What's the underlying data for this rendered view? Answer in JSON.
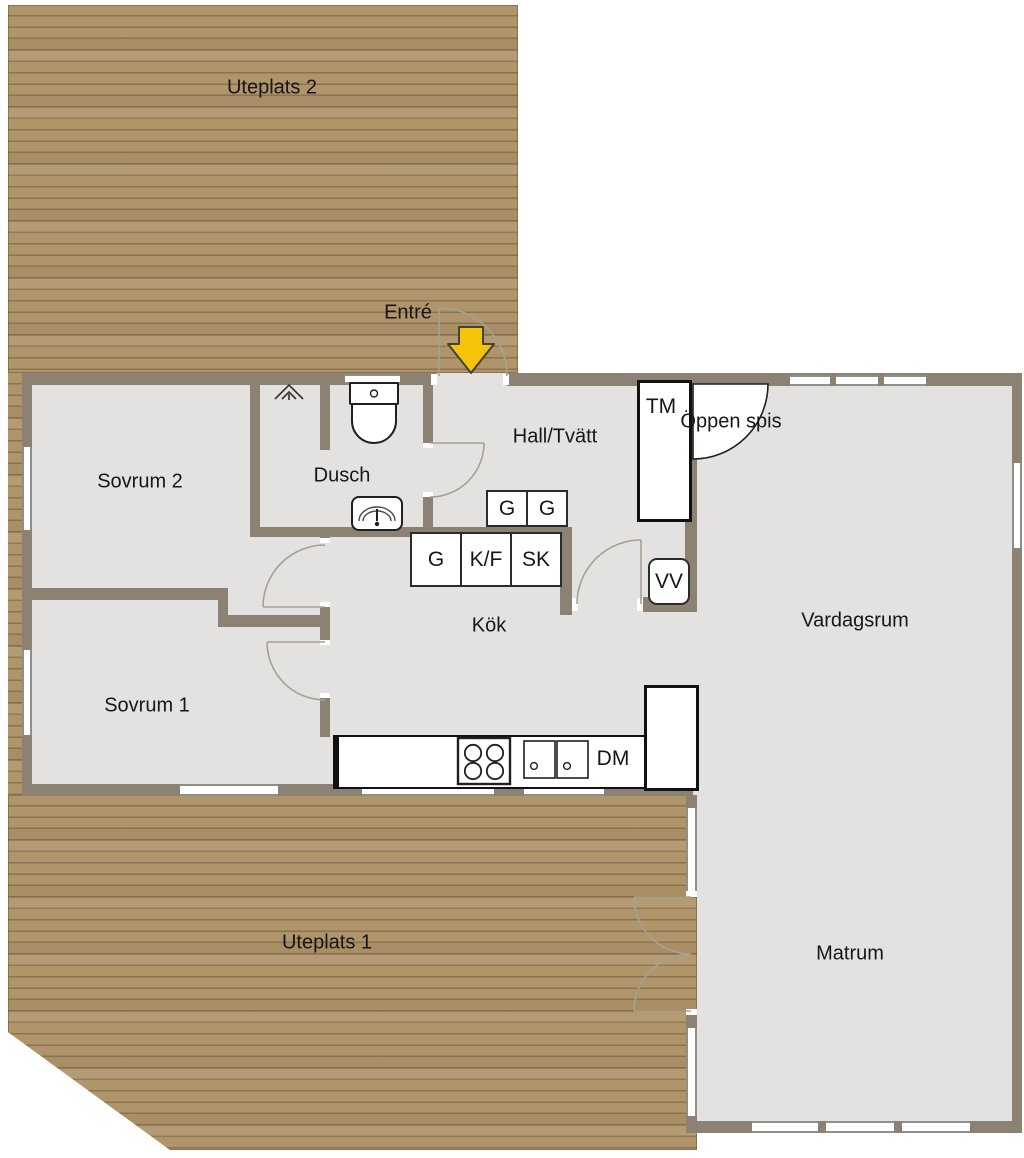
{
  "plan_title": "Floor plan with patios",
  "decks": {
    "uteplats2": "Uteplats 2",
    "uteplats1": "Uteplats 1"
  },
  "entrance": {
    "label": "Entré"
  },
  "rooms": {
    "sovrum2": "Sovrum 2",
    "sovrum1": "Sovrum 1",
    "dusch": "Dusch",
    "hall": "Hall/Tvätt",
    "kok": "Kök",
    "vardagsrum": "Vardagsrum",
    "matrum": "Matrum",
    "oppen_spis": "Öppen spis"
  },
  "cabinets": {
    "wardrobe": "G",
    "fridge_freezer": "K/F",
    "cleaning_closet": "SK",
    "washing_machine": "TM",
    "water_heater": "VV",
    "dishwasher": "DM"
  },
  "icons": {
    "entrance_arrow": "down-arrow",
    "toilet": "toilet",
    "washbasin": "washbasin",
    "stove": "stove-4-burners",
    "kitchen_sink": "double-basin-sink",
    "ceiling_vent": "vent",
    "fireplace": "open-fireplace-quarter-circle"
  },
  "colors": {
    "wall": "#8B8273",
    "floor": "#E3E2E0",
    "deck": "#B0956B",
    "deck_line": "#8A7353",
    "arrow": "#F5C40A",
    "outline": "#1F1F1F",
    "door_arc": "#A7A093"
  }
}
